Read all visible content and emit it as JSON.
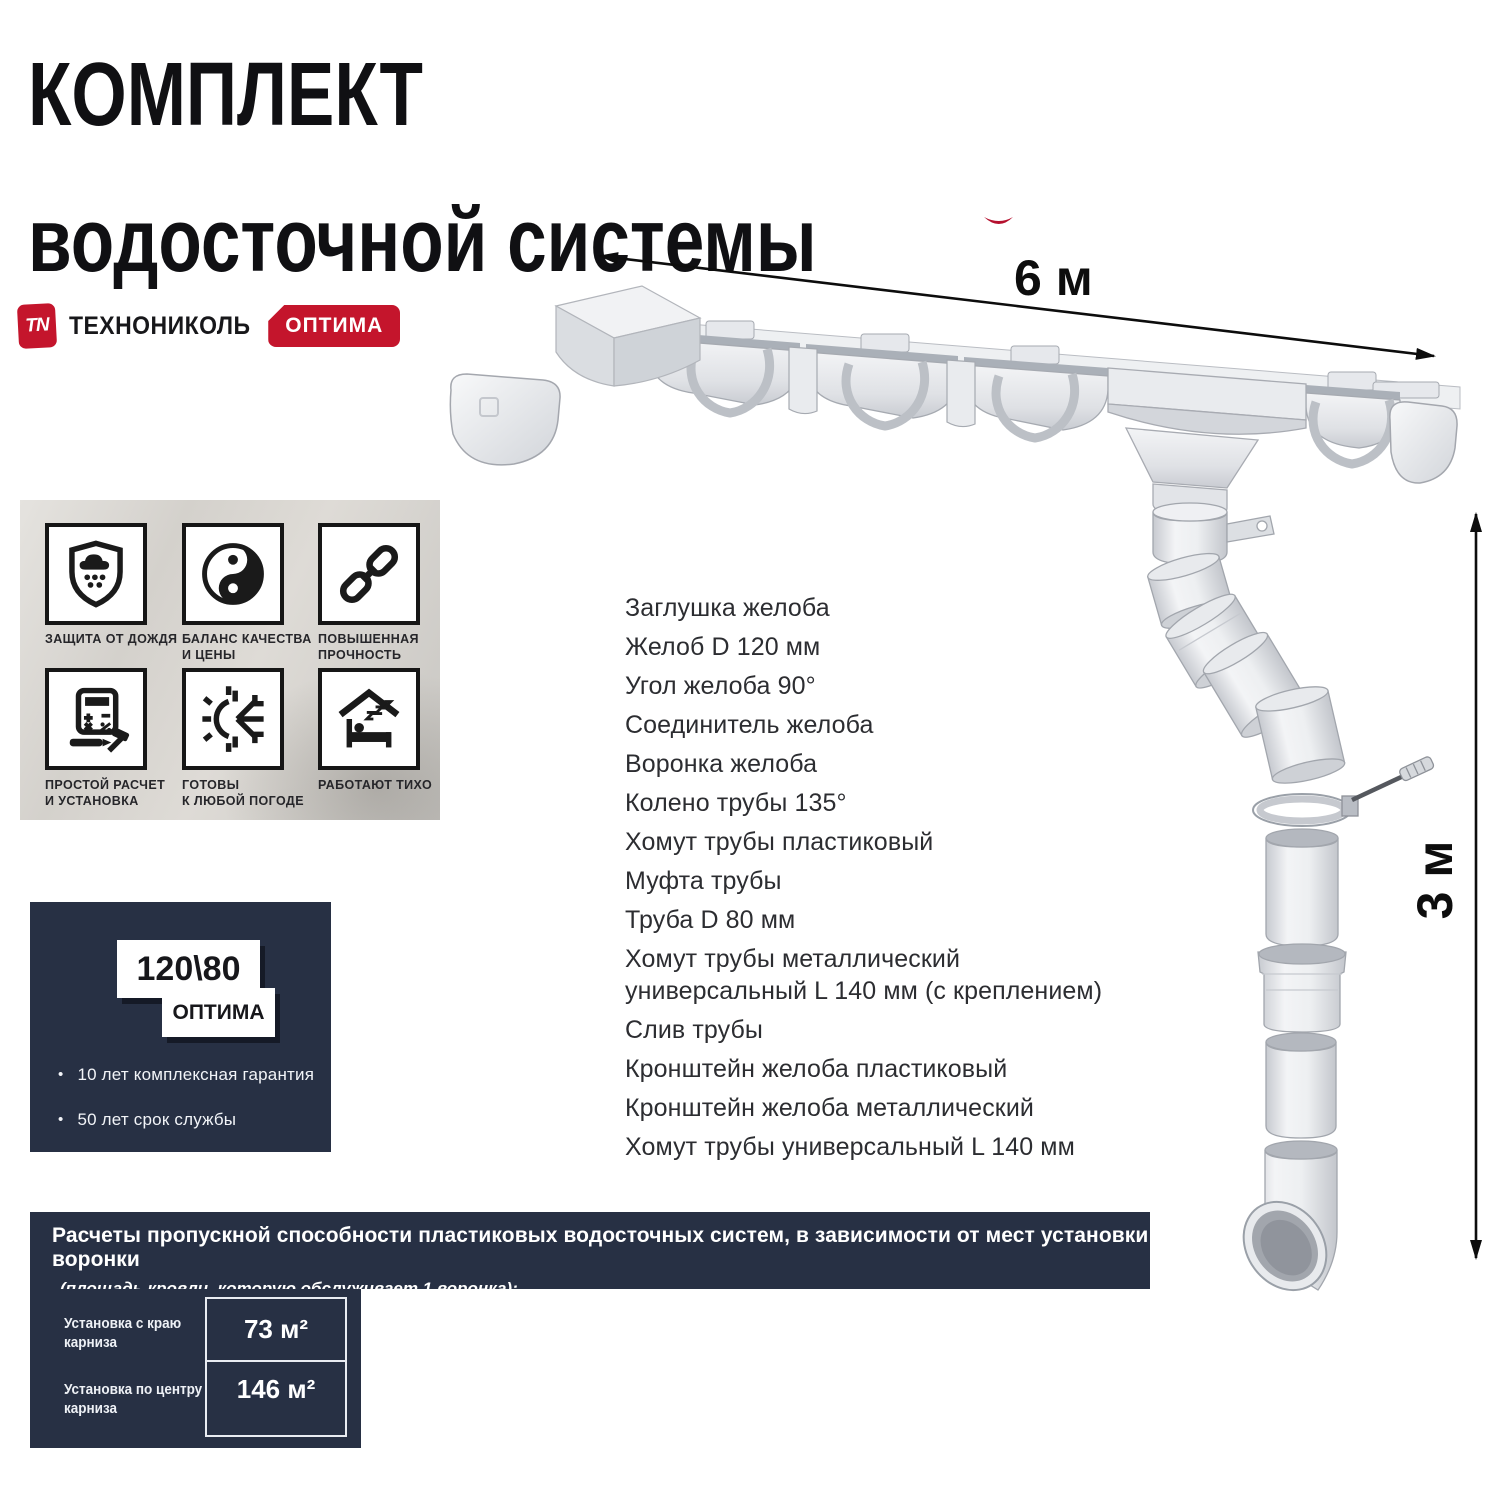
{
  "title": {
    "text": "КОМПЛЕКТ\nводосточной системы"
  },
  "brand": {
    "logo_abbr": "TN",
    "logo_text": "ТЕХНОНИКОЛЬ",
    "series_badge": "ОПТИМА"
  },
  "dimensions": {
    "gutter_length": "6 м",
    "downpipe_height": "3 м"
  },
  "features": {
    "items": [
      {
        "icon": "shield-rain-icon",
        "label": "ЗАЩИТА ОТ ДОЖДЯ"
      },
      {
        "icon": "yin-yang-icon",
        "label": "БАЛАНС КАЧЕСТВА\nИ ЦЕНЫ"
      },
      {
        "icon": "chain-icon",
        "label": "ПОВЫШЕННАЯ\nПРОЧНОСТЬ"
      },
      {
        "icon": "calculator-icon",
        "label": "ПРОСТОЙ РАСЧЕТ\nИ УСТАНОВКА"
      },
      {
        "icon": "sun-snowflake-icon",
        "label": "ГОТОВЫ\nК ЛЮБОЙ ПОГОДЕ"
      },
      {
        "icon": "quiet-home-icon",
        "label": "РАБОТАЮТ ТИХО"
      }
    ]
  },
  "spec_card": {
    "size_label": "120\\80",
    "series_label": "ОПТИМА",
    "bullets": [
      "10 лет  комплексная гарантия",
      "50 лет срок службы"
    ]
  },
  "parts": {
    "items": [
      "Заглушка желоба",
      "Желоб D 120 мм",
      "Угол желоба 90°",
      "Соединитель желоба",
      "Воронка желоба",
      "Колено трубы 135°",
      "Хомут трубы пластиковый",
      "Муфта трубы",
      "Труба D 80 мм",
      "Хомут трубы металлический\nуниверсальный L 140 мм (с креплением)",
      "Слив трубы",
      "Кронштейн желоба пластиковый",
      "Кронштейн желоба металлический",
      "Хомут трубы универсальный L 140 мм"
    ]
  },
  "capacity": {
    "heading": "Расчеты пропускной способности пластиковых водосточных систем, в зависимости от мест установки воронки",
    "subheading": "(площадь кровли, которую обслуживает 1 воронка):",
    "rows": [
      {
        "label": "Установка с краю\nкарниза",
        "value": "73 м²"
      },
      {
        "label": "Установка по центру\nкарниза",
        "value": "146 м²"
      }
    ]
  },
  "colors": {
    "accent_red": "#c4152c",
    "navy": "#273044"
  }
}
